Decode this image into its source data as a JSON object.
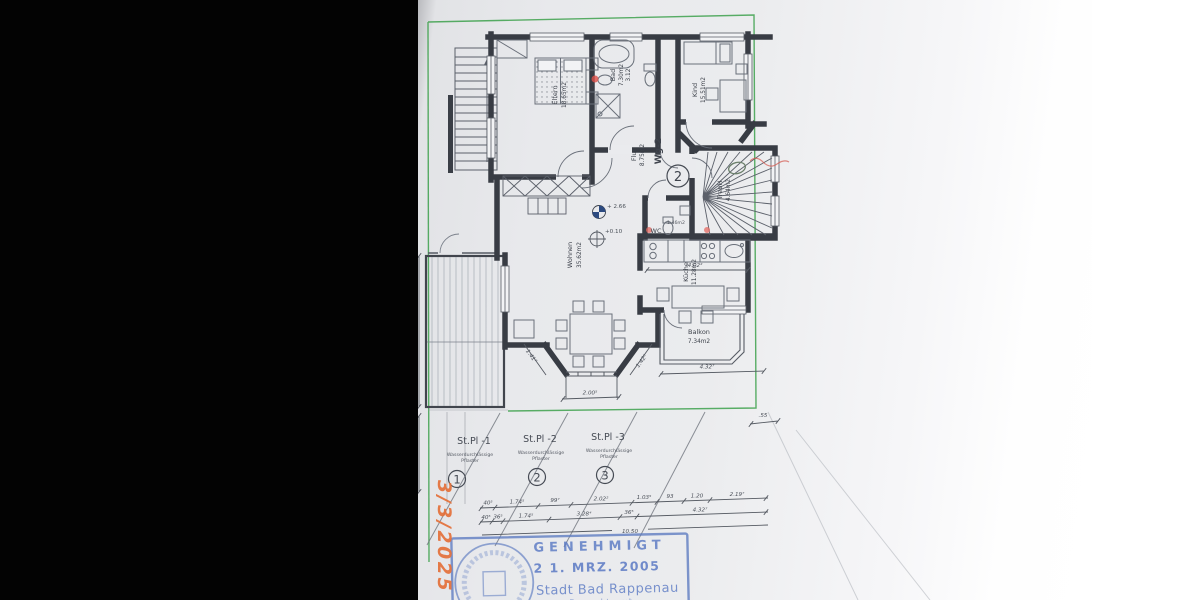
{
  "unit": {
    "label": "Wg-2",
    "number": "2"
  },
  "rooms": {
    "eltern": {
      "name": "Eltern",
      "area": "18.65m2"
    },
    "bad": {
      "name": "Bad",
      "area": "7.30m2",
      "width": "3.12"
    },
    "kind": {
      "name": "Kind",
      "area": "15.51m2"
    },
    "flur": {
      "name": "Flur",
      "area": "8.75m2"
    },
    "treph": {
      "name": "TrepH",
      "area": "4.64m2"
    },
    "wc": {
      "name": "WC",
      "area": "1.46m2"
    },
    "wohnen": {
      "name": "Wohnen",
      "area": "35.62m2"
    },
    "kueche": {
      "name": "Küche",
      "area": "11.28m2"
    },
    "balkon": {
      "name": "Balkon",
      "area": "7.34m2"
    }
  },
  "levels": {
    "upper": "+ 2.66",
    "entry": "+0.10"
  },
  "parking": {
    "stall1": {
      "label": "St.Pl -1",
      "surface1": "Wasserdurchlässige",
      "surface2": "Pflaster",
      "number": "1"
    },
    "stall2": {
      "label": "St.Pl -2",
      "surface1": "Wasserdurchlässige",
      "surface2": "Pflaster",
      "number": "2"
    },
    "stall3": {
      "label": "St.Pl -3",
      "surface1": "Wasserdurchlässige",
      "surface2": "Pflaster",
      "number": "3"
    }
  },
  "dims": {
    "terrace": "6.00",
    "offset": ".55",
    "kitchen": "4.02²",
    "balcony": "4.32⁷",
    "bay_left": "1.41⁷",
    "bay_mid": "2.00⁵",
    "bay_right": "1.42⁵",
    "row1": {
      "d1": "40⁵",
      "d2": "1.74⁵",
      "d3": "99⁷",
      "d4": "2.02²",
      "d5": "1.03⁵",
      "d6": "93",
      "d7": "1.20",
      "d8": "2.19⁷"
    },
    "row2": {
      "d1": "40⁵",
      "d2": "36⁵",
      "d3": "1.74⁵",
      "d4": "3.28⁴",
      "d5": "36⁵",
      "d6": "4.32⁷"
    },
    "total": "10.50"
  },
  "stamp": {
    "approved": "GENEHMIGT",
    "date": "2 1. MRZ. 2005",
    "city": "Stadt Bad Rappenau",
    "office": "Baurechtsamt"
  },
  "annotations": {
    "handwritten_date": "3/3/2025"
  },
  "colors": {
    "boundary_green": "#3da14c",
    "stamp_blue": "#5b7ac4",
    "marker_red": "#de5048",
    "handwriting_orange": "#e4703a"
  }
}
